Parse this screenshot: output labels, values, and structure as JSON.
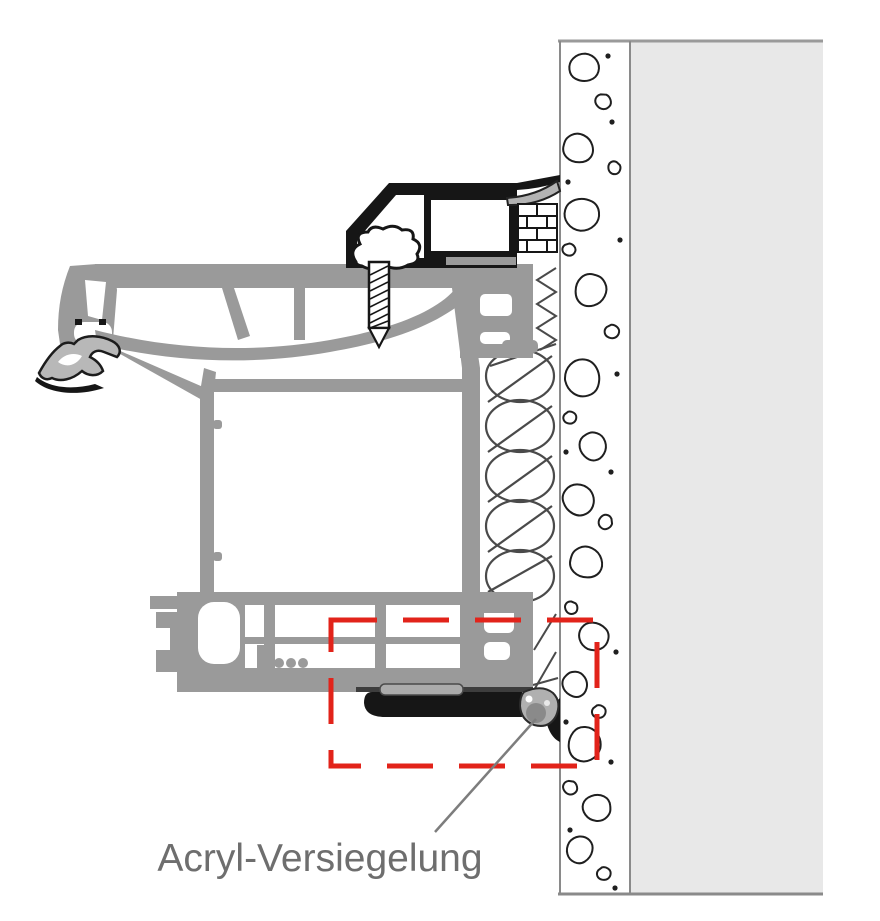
{
  "figure": {
    "kind": "installation-cross-section",
    "annotation": {
      "label": "Acryl-Versiegelung"
    }
  },
  "colors": {
    "highlight_red": "#e2231a",
    "label_gray": "#6e6e6e",
    "frame_gray": "#9a9a9a",
    "wall_gray": "#e8e8e8",
    "outline_black": "#161616",
    "seal_body_gray": "#b0b0b0",
    "seal_core_gray": "#8a8a8a",
    "pointer_gray": "#7d7d7d"
  }
}
